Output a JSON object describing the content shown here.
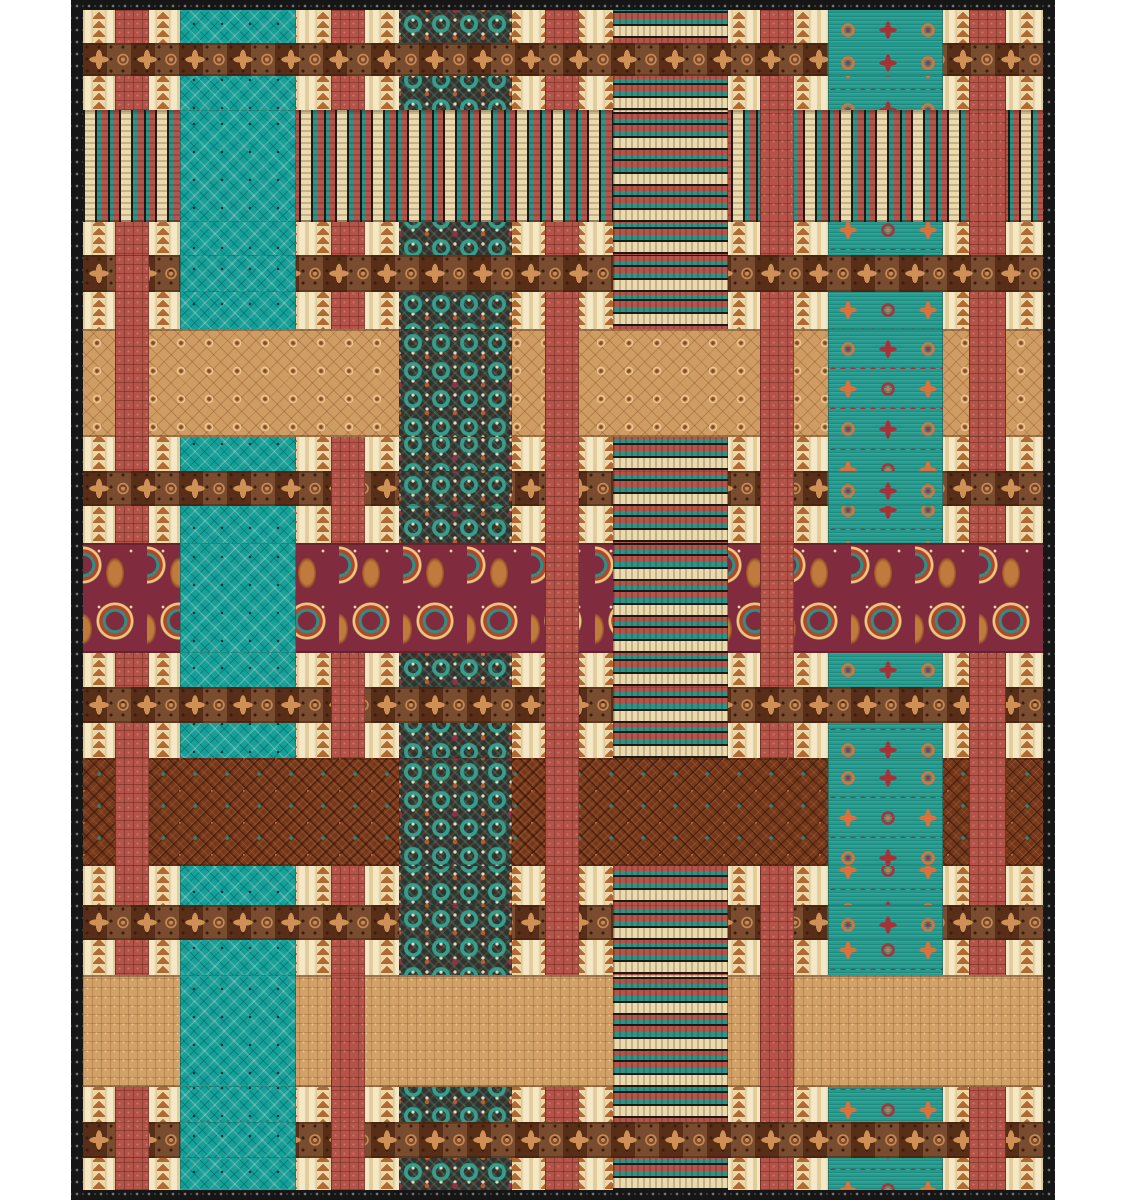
{
  "page": {
    "width": 1125,
    "height": 1200,
    "background": "#ffffff"
  },
  "quilt": {
    "left": 71,
    "top": 0,
    "width": 984,
    "height": 1200,
    "border": {
      "fabric": "border",
      "side_thickness": 12,
      "top_thickness": 10,
      "bottom_thickness": 10,
      "color": "#161616",
      "ornament_color": "#8d8d8d"
    },
    "background_fabric": "cream",
    "fabrics": {
      "border": {
        "name": "black-ornament-binding",
        "base": "#161616",
        "accent": "#8d8d8d"
      },
      "cream": {
        "name": "cream-arrow-stripe",
        "base": "#ecdcb2",
        "accent": "#b06a31",
        "shade": "#dcc28f"
      },
      "rust": {
        "name": "rust-waffle",
        "base": "#b35349",
        "accent": "#cd7466"
      },
      "teal": {
        "name": "teal-diamond-lattice",
        "base": "#14a19a",
        "accent": "#5ec4b8",
        "dot": "#06393b"
      },
      "tealx": {
        "name": "charcoal-teal-kaleidoscope",
        "base": "#30332f",
        "accent": "#34a492",
        "accent2": "#c2592c",
        "accent3": "#ead9b8",
        "accent4": "#8e3345"
      },
      "stripev": {
        "name": "serape-stripe-vertical",
        "colors": [
          "#1a1a16",
          "#ecd9ac",
          "#2e9488",
          "#b5544a"
        ]
      },
      "stripeh": {
        "name": "serape-stripe-horizontal",
        "colors": [
          "#1a1a16",
          "#ecd9ac",
          "#2e9488",
          "#b5544a"
        ]
      },
      "browngeo": {
        "name": "brown-cross-diamond-band",
        "base": "#6b3a1e",
        "accent": "#cf9055",
        "dark": "#3c1e0e"
      },
      "tandia": {
        "name": "tan-diamond-trellis",
        "base": "#cf9c63",
        "accent": "#8a4a26"
      },
      "tanbas": {
        "name": "tan-basketweave",
        "base": "#d2a167",
        "accent": "#e9c391"
      },
      "darkbrown": {
        "name": "chocolate-diamond-teal-dot",
        "base": "#74381c",
        "accent": "#2e8274",
        "accent2": "#c2602a"
      },
      "tealsw": {
        "name": "teal-southwest-medallion",
        "base": "#259a8e",
        "accent": "#e0703a",
        "accent2": "#b03038"
      },
      "burgundy": {
        "name": "burgundy-folk-floral",
        "base": "#802b3e",
        "accent": "#c07a3c",
        "accent2": "#2e8f82",
        "accent3": "#e8c87a"
      }
    },
    "columns": [
      {
        "id": "rust-1",
        "fabric": "rust",
        "x": 32,
        "w": 34,
        "over": [
          "b3",
          "b4",
          "b8",
          "b11"
        ]
      },
      {
        "id": "teal-diamond",
        "fabric": "teal",
        "x": 97,
        "w": 116,
        "over": [
          "b2",
          "b3",
          "b6",
          "b10",
          "b11"
        ]
      },
      {
        "id": "rust-2",
        "fabric": "rust",
        "x": 248,
        "w": 34,
        "over": [
          "b5",
          "b7",
          "b10",
          "b11"
        ]
      },
      {
        "id": "teal-cross",
        "fabric": "tealx",
        "x": 316,
        "w": 113,
        "over": [
          "b4",
          "b5",
          "b8",
          "b9"
        ]
      },
      {
        "id": "rust-3",
        "fabric": "rust",
        "x": 462,
        "w": 34,
        "over": [
          "b4",
          "b5",
          "b6",
          "b7",
          "b8",
          "b9"
        ]
      },
      {
        "id": "serape-strip",
        "fabric": "stripeh",
        "x": 530,
        "w": 115,
        "over": [
          "b2",
          "b3",
          "b5",
          "b6",
          "b7",
          "b9",
          "b10"
        ]
      },
      {
        "id": "rust-4",
        "fabric": "rust",
        "x": 677,
        "w": 34,
        "over": [
          "b2",
          "b4",
          "b5",
          "b6",
          "b9",
          "b10"
        ]
      },
      {
        "id": "teal-sw",
        "fabric": "tealsw",
        "x": 745,
        "w": 115,
        "over": [
          "b1",
          "b4",
          "b5",
          "b8",
          "b9"
        ]
      },
      {
        "id": "rust-5",
        "fabric": "rust",
        "x": 886,
        "w": 37,
        "over": [
          "b2",
          "b4",
          "b7",
          "b8",
          "b11"
        ]
      }
    ],
    "bands": [
      {
        "id": "b1",
        "fabric": "browngeo",
        "y": 33,
        "h": 33
      },
      {
        "id": "b2",
        "fabric": "stripev",
        "y": 100,
        "h": 112
      },
      {
        "id": "b3",
        "fabric": "browngeo",
        "y": 245,
        "h": 37
      },
      {
        "id": "b4",
        "fabric": "tandia",
        "y": 319,
        "h": 108
      },
      {
        "id": "b5",
        "fabric": "browngeo",
        "y": 461,
        "h": 35
      },
      {
        "id": "b6",
        "fabric": "burgundy",
        "y": 533,
        "h": 110
      },
      {
        "id": "b7",
        "fabric": "browngeo",
        "y": 677,
        "h": 36
      },
      {
        "id": "b8",
        "fabric": "darkbrown",
        "y": 748,
        "h": 108
      },
      {
        "id": "b9",
        "fabric": "browngeo",
        "y": 895,
        "h": 35
      },
      {
        "id": "b10",
        "fabric": "tanbas",
        "y": 965,
        "h": 112
      },
      {
        "id": "b11",
        "fabric": "browngeo",
        "y": 1112,
        "h": 36
      }
    ]
  }
}
